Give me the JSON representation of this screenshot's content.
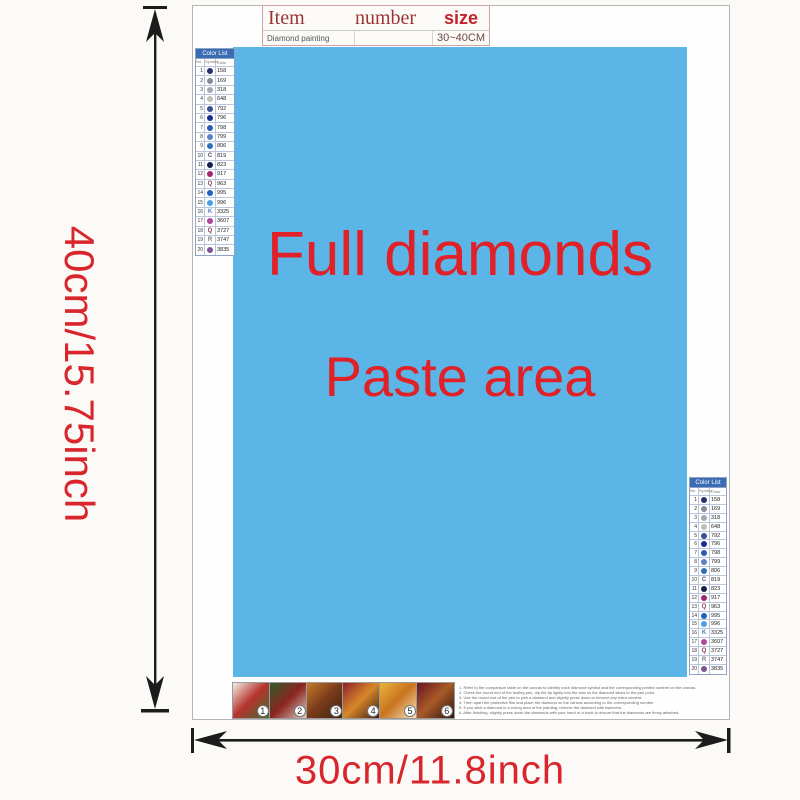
{
  "dimensions": {
    "height_label": "40cm/15.75inch",
    "width_label": "30cm/11.8inch",
    "arrow_color": "#1c1c1c",
    "label_color": "#d9252c"
  },
  "item_table": {
    "col_item": "Item",
    "col_number": "number",
    "col_size": "size",
    "row_item": "Diamond painting",
    "row_number": "",
    "row_size": "30~40CM"
  },
  "paste_area": {
    "line1": "Full diamonds",
    "line2": "Paste area",
    "bg_color": "#5cb5e7",
    "text_color": "#e02128"
  },
  "color_list": {
    "title": "Color List",
    "title_bg": "#3a6cb4",
    "columns": [
      "No.",
      "Symbol",
      "Color"
    ],
    "rows": [
      {
        "no": "1",
        "symbol": "circle",
        "color": "#27306b",
        "code": "158"
      },
      {
        "no": "2",
        "symbol": "circle",
        "color": "#878c94",
        "code": "169"
      },
      {
        "no": "3",
        "symbol": "circle",
        "color": "#a3a8ae",
        "code": "318"
      },
      {
        "no": "4",
        "symbol": "circle",
        "color": "#c2bfb2",
        "code": "648"
      },
      {
        "no": "5",
        "symbol": "circle",
        "color": "#3b4f93",
        "code": "792"
      },
      {
        "no": "6",
        "symbol": "circle",
        "color": "#1a2d91",
        "code": "796"
      },
      {
        "no": "7",
        "symbol": "circle",
        "color": "#2d5bb0",
        "code": "798"
      },
      {
        "no": "8",
        "symbol": "circle",
        "color": "#5d7fc4",
        "code": "799"
      },
      {
        "no": "9",
        "symbol": "circle",
        "color": "#2d6fb8",
        "code": "806"
      },
      {
        "no": "10",
        "symbol": "letter",
        "letter": "C",
        "color": "#55586a",
        "code": "819"
      },
      {
        "no": "11",
        "symbol": "circle",
        "color": "#16204e",
        "code": "823"
      },
      {
        "no": "12",
        "symbol": "circle",
        "color": "#a2266f",
        "code": "917"
      },
      {
        "no": "13",
        "symbol": "letter",
        "letter": "Q",
        "color": "#8a4455",
        "code": "963"
      },
      {
        "no": "14",
        "symbol": "circle",
        "color": "#1d63c0",
        "code": "995"
      },
      {
        "no": "15",
        "symbol": "circle",
        "color": "#4aa3e0",
        "code": "996"
      },
      {
        "no": "16",
        "symbol": "letter",
        "letter": "K",
        "color": "#4a7ec0",
        "code": "3325"
      },
      {
        "no": "17",
        "symbol": "circle",
        "color": "#b04898",
        "code": "3607"
      },
      {
        "no": "18",
        "symbol": "letter",
        "letter": "Q",
        "color": "#8c3a50",
        "code": "3727"
      },
      {
        "no": "19",
        "symbol": "letter",
        "letter": "R",
        "color": "#76797e",
        "code": "3747"
      },
      {
        "no": "20",
        "symbol": "circle",
        "color": "#7e5494",
        "code": "3835"
      }
    ]
  },
  "steps": [
    {
      "number": "1",
      "colors": [
        "#f3efe6",
        "#b5342c",
        "#3f6b35"
      ]
    },
    {
      "number": "2",
      "colors": [
        "#2e5d2a",
        "#8a2420",
        "#d8cfc0"
      ]
    },
    {
      "number": "3",
      "colors": [
        "#c77a28",
        "#7a3b1a",
        "#3a2413"
      ]
    },
    {
      "number": "4",
      "colors": [
        "#8c1f2a",
        "#d8882a",
        "#3a1a14"
      ]
    },
    {
      "number": "5",
      "colors": [
        "#e8b53a",
        "#c9731f",
        "#f5e6c0"
      ]
    },
    {
      "number": "6",
      "colors": [
        "#6b1420",
        "#a85a28",
        "#2f1410"
      ]
    }
  ],
  "instructions": {
    "lines": [
      "Refer to the comparison table on the canvas to identify each diamond symbol and the corresponding printed number on the canvas.",
      "Check the round end of the tooling pen, dip the tip lightly into the wax so the diamond sticks to the pen point.",
      "Use the round end of the pen to pick a diamond and slightly press down to remove any extra cement.",
      "Then apart the protective film and place the diamond on the canvas according to the corresponding number.",
      "If you stick a diamond in a wrong area of the painting, remove the diamond with tweezers.",
      "After finishing, slightly press down the diamonds with your hand or a book to ensure that the diamonds are firmly attached."
    ]
  }
}
